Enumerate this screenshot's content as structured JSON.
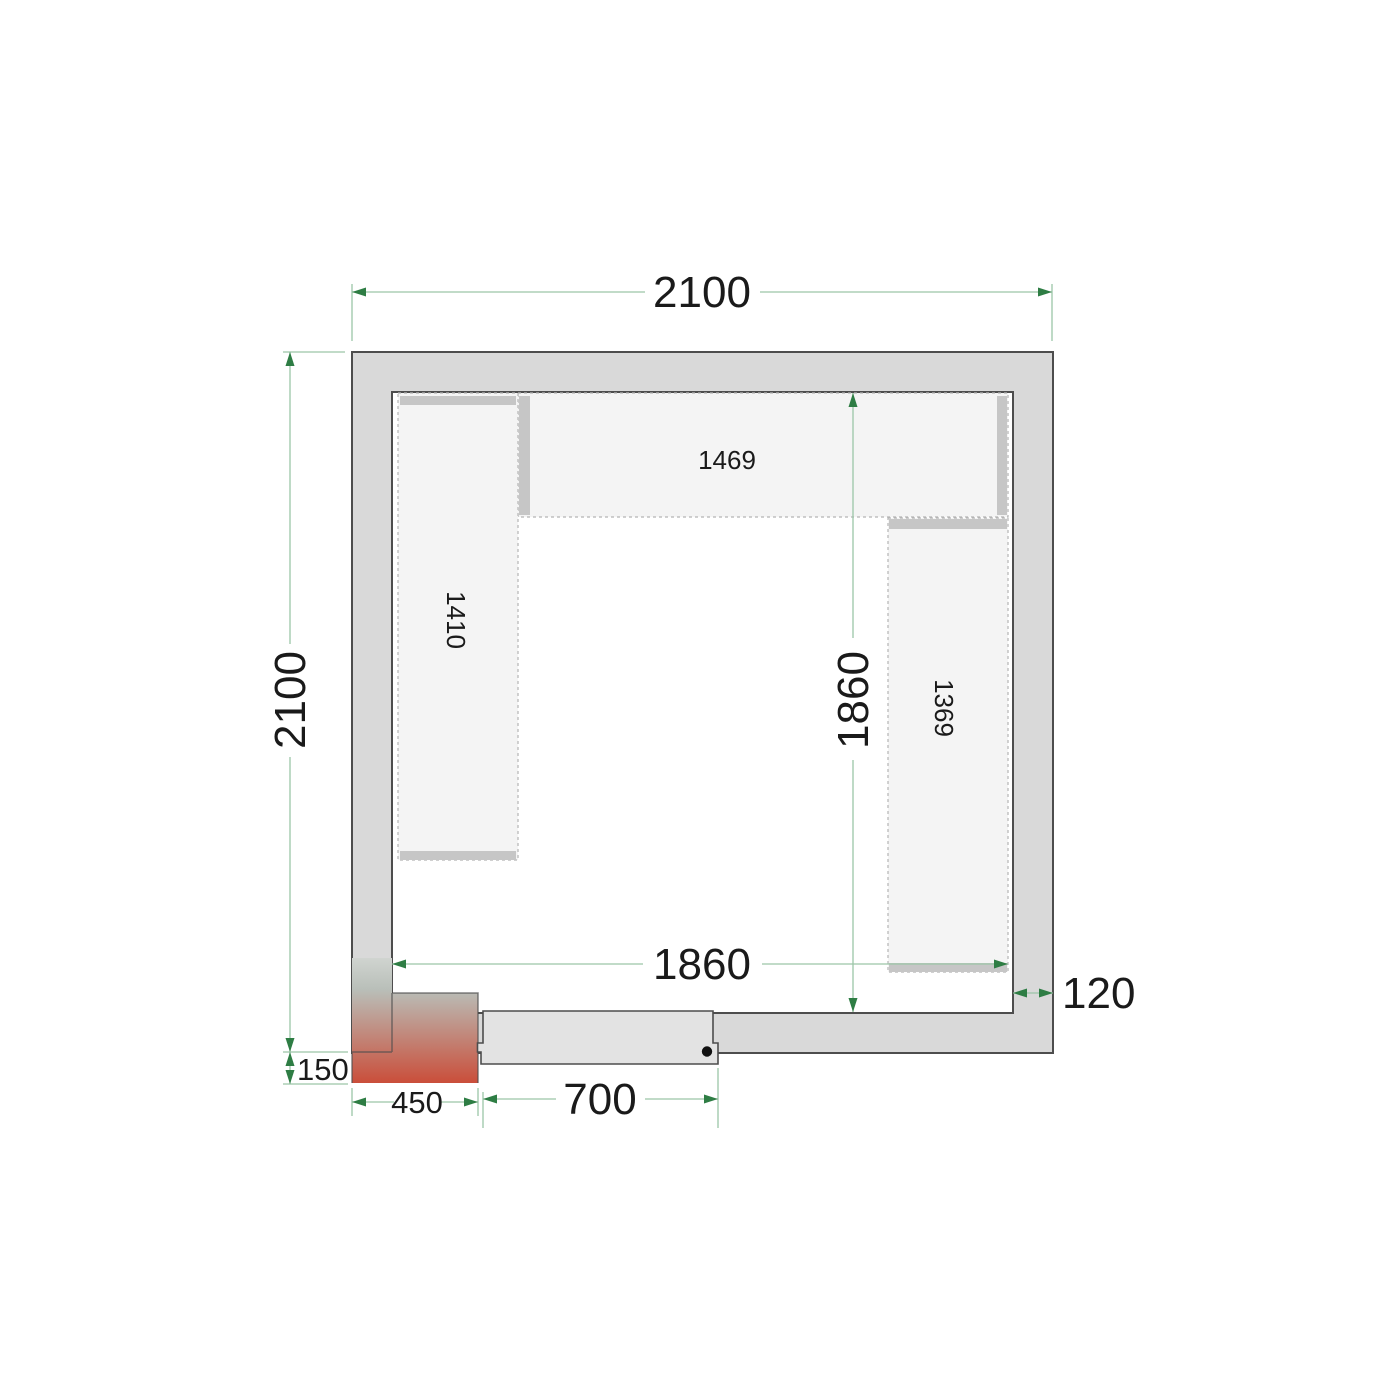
{
  "plan": {
    "dim_outer_width": "2100",
    "dim_outer_height": "2100",
    "dim_inner_width": "1860",
    "dim_inner_height": "1860",
    "dim_wall_thickness": "120",
    "dim_unit_offset": "150",
    "dim_unit_width": "450",
    "dim_door_width": "700",
    "shelf_top_length": "1469",
    "shelf_left_length": "1410",
    "shelf_right_length": "1369"
  },
  "colors": {
    "wall_fill": "#d9d9d9",
    "wall_outline": "#4d4d4d",
    "dimension_line_green": "#9cc5a8",
    "arrow_green": "#2e7d44",
    "shelf_fill": "#f4f4f4",
    "shelf_dash": "#b5b5b5",
    "support_bar": "#c6c6c6",
    "door_fill": "#e3e3e3",
    "unit_red": "#ca4e3a",
    "unit_gray": "#b9bfb9"
  }
}
